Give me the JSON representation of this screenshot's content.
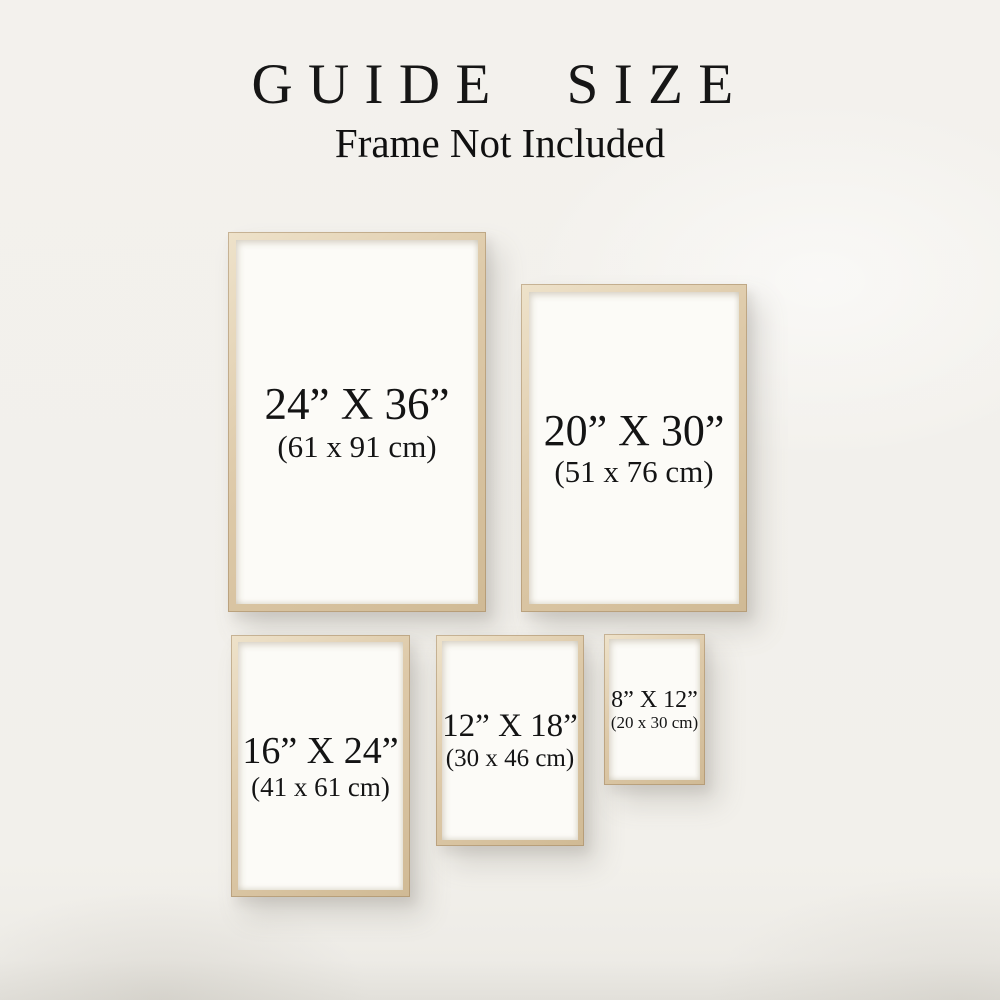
{
  "header": {
    "title": "GUIDE SIZE",
    "subtitle": "Frame Not Included"
  },
  "frames": [
    {
      "inches": "24” X 36”",
      "cm": "(61 x 91 cm)"
    },
    {
      "inches": "20” X 30”",
      "cm": "(51 x 76 cm)"
    },
    {
      "inches": "16” X 24”",
      "cm": "(41 x 61 cm)"
    },
    {
      "inches": "12” X 18”",
      "cm": "(30 x 46 cm)"
    },
    {
      "inches": "8” X 12”",
      "cm": "(20 x 30 cm)"
    }
  ],
  "colors": {
    "wall_background": "#f2f0eb",
    "frame_wood": "#dcc8a7",
    "paper": "#fcfbf7",
    "text": "#141414"
  }
}
